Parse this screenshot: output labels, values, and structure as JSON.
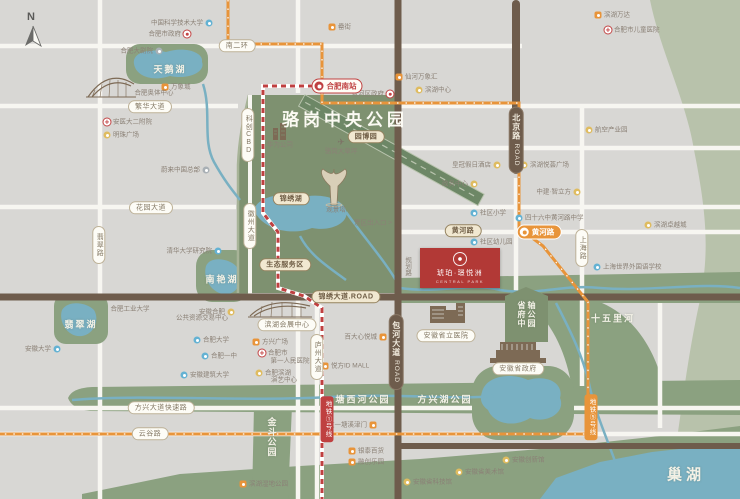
{
  "compass_n": "N",
  "park": {
    "title": "骆岗中央公园"
  },
  "project": {
    "name": "琥珀·璟悦洲",
    "tagline": "CENTRAL PARK"
  },
  "colors": {
    "background": "#d8d7d4",
    "park_green": "#7e9170",
    "strip_green": "#8ba180",
    "band_green": "#b8c2ab",
    "water": "#79b0c2",
    "road_brown": "#6e5c4c",
    "metro_red": "#bf4040",
    "metro_orange": "#e8943a",
    "project_red": "#b23936"
  },
  "road_pills": [
    {
      "id": "nanerhuan",
      "text": "南二环",
      "x": 237,
      "y": 46,
      "style": "white"
    },
    {
      "id": "fanhua-avenue",
      "text": "繁华大道",
      "x": 150,
      "y": 107,
      "style": "white"
    },
    {
      "id": "huayuan-avenue",
      "text": "花园大道",
      "x": 151,
      "y": 208,
      "style": "white"
    },
    {
      "id": "feicui-road",
      "text": "翡翠路",
      "x": 99,
      "y": 245,
      "style": "white",
      "vertical": true
    },
    {
      "id": "fangxing-expressway",
      "text": "方兴大道快速路",
      "x": 161,
      "y": 408,
      "style": "white"
    },
    {
      "id": "yungu-road",
      "text": "云谷路",
      "x": 150,
      "y": 434,
      "style": "white"
    },
    {
      "id": "kechuang-cbd",
      "text": "科创CBD",
      "x": 248,
      "y": 135,
      "style": "white",
      "vertical": true
    },
    {
      "id": "huizhou-avenue",
      "text": "徽州大道",
      "x": 250,
      "y": 226,
      "style": "white",
      "vertical": true
    },
    {
      "id": "shanghai-road",
      "text": "上海路",
      "x": 582,
      "y": 248,
      "style": "white",
      "vertical": true
    },
    {
      "id": "luzhou-avenue",
      "text": "庐州大道",
      "x": 317,
      "y": 357,
      "style": "white",
      "vertical": true
    },
    {
      "id": "huanghe-road-pill",
      "text": "黄河路",
      "x": 463,
      "y": 231,
      "style": "beige"
    },
    {
      "id": "jinxiu-avenue",
      "text": "锦绣大道.ROAD",
      "x": 346,
      "y": 297,
      "style": "beige"
    },
    {
      "id": "jinxiu-lake-pill",
      "text": "锦绣湖",
      "x": 291,
      "y": 199,
      "style": "beige"
    },
    {
      "id": "eco-service-area",
      "text": "生态服务区",
      "x": 285,
      "y": 265,
      "style": "beige"
    },
    {
      "id": "yuanboyuan",
      "text": "园博园",
      "x": 366,
      "y": 137,
      "style": "beige"
    },
    {
      "id": "beijing-road",
      "text": "北京路",
      "en": "ROAD",
      "x": 516,
      "y": 140,
      "style": "dark",
      "vertical": true
    },
    {
      "id": "baohe-avenue",
      "text": "包河大道",
      "en": "ROAD",
      "x": 396,
      "y": 352,
      "style": "dark",
      "vertical": true
    },
    {
      "id": "binhu-expo-center",
      "text": "滨湖会展中心",
      "x": 287,
      "y": 325,
      "style": "white"
    },
    {
      "id": "anhui-provincial-hospital",
      "text": "安徽省立医院",
      "x": 446,
      "y": 336,
      "style": "white"
    },
    {
      "id": "anhui-gov",
      "text": "安徽省政府",
      "x": 518,
      "y": 369,
      "style": "white"
    }
  ],
  "metro_badges": [
    {
      "id": "hefei-south-station",
      "text": "合肥南站",
      "x": 337,
      "y": 86,
      "style": "st-red"
    },
    {
      "id": "huanghe-road-station",
      "text": "黄河路",
      "x": 539,
      "y": 232,
      "style": "st-orange"
    },
    {
      "id": "metro-line-1-badge",
      "text": "地铁①号线",
      "x": 327,
      "y": 419,
      "style": "ln-red"
    },
    {
      "id": "metro-line-5-badge",
      "text": "地铁⑤号线",
      "x": 591,
      "y": 417,
      "style": "ln-orange"
    }
  ],
  "area_labels": [
    {
      "id": "tianehu",
      "text": "天鹅湖",
      "x": 170,
      "y": 69
    },
    {
      "id": "nanyanhu",
      "text": "南艳湖",
      "x": 222,
      "y": 279
    },
    {
      "id": "feicuihu",
      "text": "翡翠湖",
      "x": 81,
      "y": 324
    },
    {
      "id": "tangxihe-park",
      "text": "塘西河公园",
      "x": 363,
      "y": 399
    },
    {
      "id": "fangxinghu-park",
      "text": "方兴湖公园",
      "x": 445,
      "y": 399
    },
    {
      "id": "jindou-park",
      "text": "金斗公园",
      "x": 272,
      "y": 437,
      "vertical": true
    },
    {
      "id": "shiwulihe",
      "text": "十五里河",
      "x": 613,
      "y": 318
    },
    {
      "id": "chaohu",
      "text": "巢湖",
      "x": 686,
      "y": 474,
      "big": true
    },
    {
      "id": "shengfu-axis-park",
      "text": "省府中轴公园",
      "x": 526,
      "y": 317,
      "v3": true
    }
  ],
  "pois": [
    {
      "text": "中国科学技术大学",
      "icon": "school",
      "side": "left",
      "x": 209,
      "y": 23
    },
    {
      "text": "合肥市政府",
      "icon": "gov",
      "side": "left",
      "x": 187,
      "y": 34
    },
    {
      "text": "合肥大剧院",
      "icon": "other",
      "side": "left",
      "x": 159,
      "y": 51
    },
    {
      "text": "万象城",
      "icon": "shop",
      "side": "right",
      "x": 165,
      "y": 87
    },
    {
      "text": "合肥奥体中心",
      "icon": "none",
      "side": "center",
      "x": 154,
      "y": 93
    },
    {
      "text": "安医大二附院",
      "icon": "hospital",
      "side": "right",
      "x": 107,
      "y": 122
    },
    {
      "text": "明珠广场",
      "icon": "spot",
      "side": "right",
      "x": 107,
      "y": 135
    },
    {
      "text": "蔚来中国总部",
      "icon": "other",
      "side": "left",
      "x": 206,
      "y": 170
    },
    {
      "text": "清华大学研究院",
      "icon": "school",
      "side": "left",
      "x": 218,
      "y": 251
    },
    {
      "text": "合肥工业大学",
      "icon": "none",
      "side": "center",
      "x": 130,
      "y": 309
    },
    {
      "text": "安徽合肥",
      "icon": "spot",
      "side": "left",
      "x": 231,
      "y": 312
    },
    {
      "text": "公共资源交易中心",
      "icon": "none",
      "side": "center",
      "x": 202,
      "y": 318
    },
    {
      "text": "安徽大学",
      "icon": "school",
      "side": "left",
      "x": 57,
      "y": 349
    },
    {
      "text": "合肥大学",
      "icon": "school",
      "side": "right",
      "x": 197,
      "y": 340
    },
    {
      "text": "合肥一中",
      "icon": "school",
      "side": "right",
      "x": 205,
      "y": 356
    },
    {
      "text": "安徽建筑大学",
      "icon": "school",
      "side": "right",
      "x": 184,
      "y": 375
    },
    {
      "text": "罍街",
      "icon": "shop",
      "side": "right",
      "x": 332,
      "y": 27
    },
    {
      "text": "包河区政府",
      "icon": "gov",
      "side": "left",
      "x": 390,
      "y": 94
    },
    {
      "text": "仙河万象汇",
      "icon": "shop",
      "side": "right",
      "x": 399,
      "y": 77
    },
    {
      "text": "滨湖中心",
      "icon": "spot",
      "side": "right",
      "x": 419,
      "y": 90
    },
    {
      "text": "滨湖万达",
      "icon": "shop",
      "side": "right",
      "x": 598,
      "y": 15
    },
    {
      "text": "合肥市儿童医院",
      "icon": "hospital",
      "side": "right",
      "x": 608,
      "y": 30
    },
    {
      "text": "航空产业园",
      "icon": "spot",
      "side": "right",
      "x": 589,
      "y": 130
    },
    {
      "text": "皇冠假日酒店",
      "icon": "spot",
      "side": "left",
      "x": 497,
      "y": 165
    },
    {
      "text": "政务中心",
      "icon": "spot",
      "side": "left",
      "x": 474,
      "y": 184
    },
    {
      "text": "滨湖悦荟广场",
      "icon": "spot",
      "side": "right",
      "x": 524,
      "y": 165
    },
    {
      "text": "中建·智立方",
      "icon": "spot",
      "side": "left",
      "x": 577,
      "y": 192
    },
    {
      "text": "社区小学",
      "icon": "school",
      "side": "right",
      "x": 474,
      "y": 213
    },
    {
      "text": "社区幼儿园",
      "icon": "school",
      "side": "right",
      "x": 474,
      "y": 242
    },
    {
      "text": "四十六中黄河路中学",
      "icon": "school",
      "side": "right",
      "x": 519,
      "y": 218
    },
    {
      "text": "上海世界外国语学校",
      "icon": "school",
      "side": "right",
      "x": 597,
      "y": 267
    },
    {
      "text": "滨湖卓越城",
      "icon": "spot",
      "side": "right",
      "x": 648,
      "y": 225
    },
    {
      "text": "华为公司",
      "icon": "none",
      "side": "center",
      "x": 280,
      "y": 145
    },
    {
      "text": "骆岗大草坪",
      "icon": "plane",
      "side": "below",
      "x": 341,
      "y": 142
    },
    {
      "text": "观景塔",
      "icon": "none",
      "side": "center",
      "x": 336,
      "y": 210
    },
    {
      "text": "景区出入口 >",
      "icon": "none",
      "side": "center",
      "x": 373,
      "y": 223
    },
    {
      "text": "规划路",
      "icon": "none",
      "side": "center",
      "x": 407,
      "y": 266,
      "vertical": true
    },
    {
      "text": "方兴广场",
      "icon": "shop",
      "side": "right",
      "x": 256,
      "y": 342
    },
    {
      "text": "合肥市",
      "icon": "hospital",
      "side": "right",
      "x": 262,
      "y": 353
    },
    {
      "text": "第一人民医院",
      "icon": "none",
      "side": "center",
      "x": 290,
      "y": 361
    },
    {
      "text": "合肥滨湖",
      "icon": "spot",
      "side": "right",
      "x": 259,
      "y": 373
    },
    {
      "text": "演艺中心",
      "icon": "none",
      "side": "center",
      "x": 284,
      "y": 380
    },
    {
      "text": "悦方ID MALL",
      "icon": "shop",
      "side": "right",
      "x": 325,
      "y": 366
    },
    {
      "text": "百大心悦城",
      "icon": "shop",
      "side": "left",
      "x": 383,
      "y": 337
    },
    {
      "text": "文一塘溪津门",
      "icon": "shop",
      "side": "left",
      "x": 373,
      "y": 425
    },
    {
      "text": "银泰百货",
      "icon": "shop",
      "side": "right",
      "x": 352,
      "y": 451
    },
    {
      "text": "融创乐园",
      "icon": "shop",
      "side": "right",
      "x": 352,
      "y": 462
    },
    {
      "text": "安徽省科技馆",
      "icon": "spot",
      "side": "right",
      "x": 407,
      "y": 482
    },
    {
      "text": "安徽省美术馆",
      "icon": "spot",
      "side": "right",
      "x": 459,
      "y": 472
    },
    {
      "text": "安徽创新馆",
      "icon": "spot",
      "side": "right",
      "x": 506,
      "y": 460
    },
    {
      "text": "滨湖湿地公园",
      "icon": "shop",
      "side": "right",
      "x": 243,
      "y": 484
    }
  ]
}
